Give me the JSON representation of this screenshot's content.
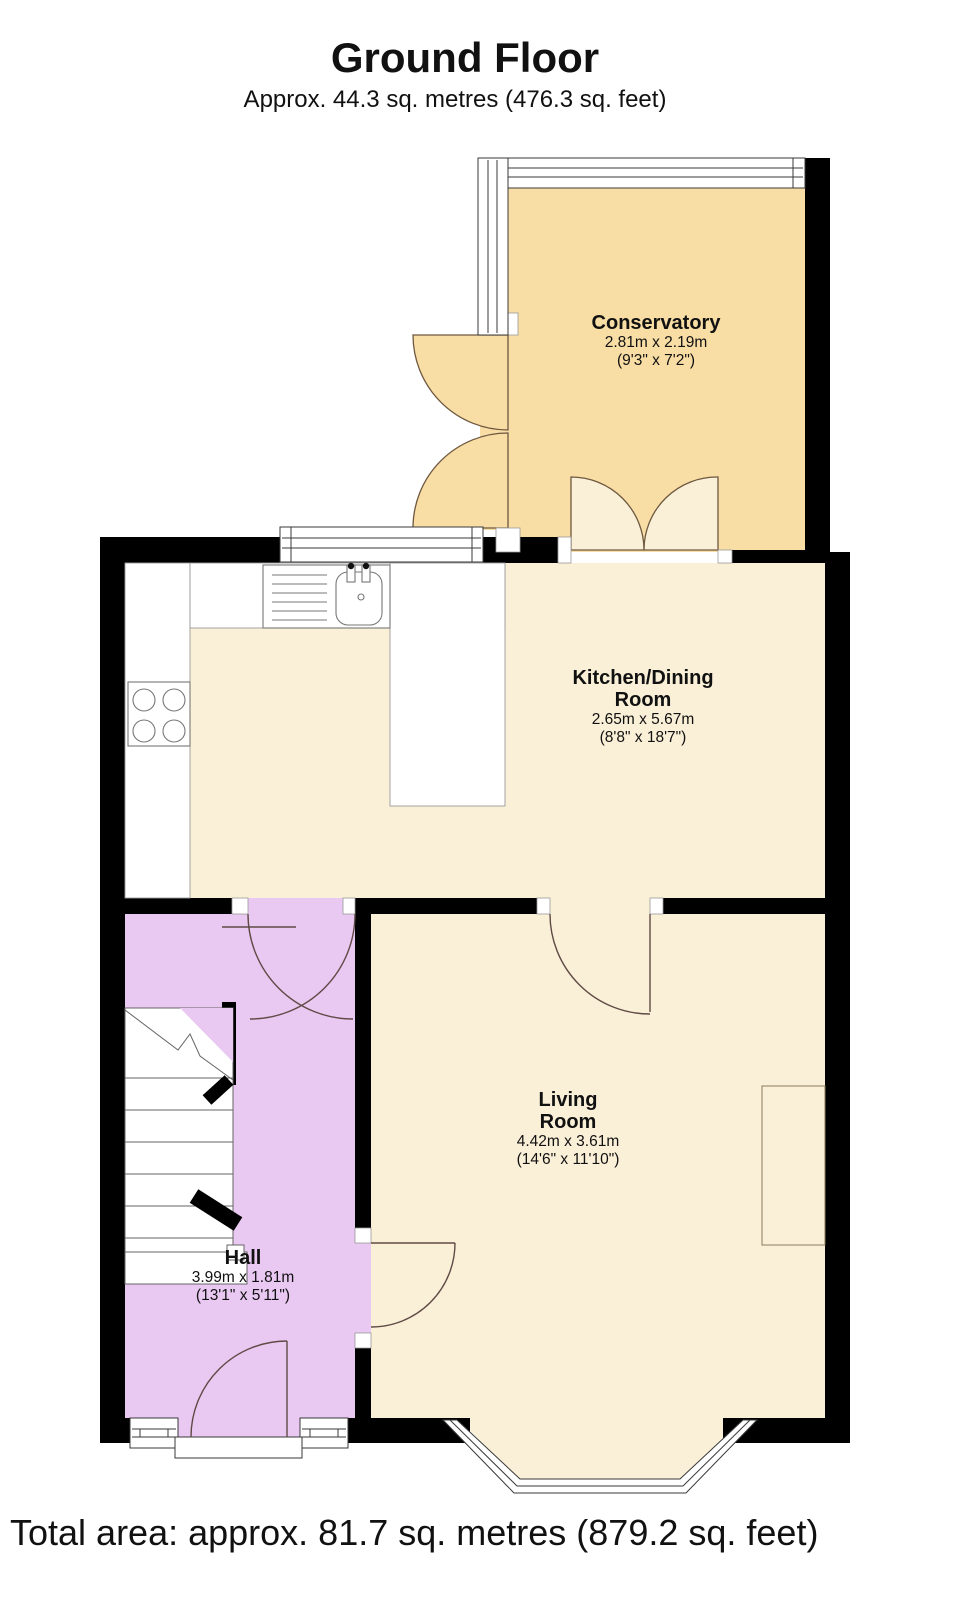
{
  "header": {
    "title": "Ground Floor",
    "subtitle": "Approx. 44.3 sq. metres (476.3 sq. feet)"
  },
  "footer": {
    "total_area": "Total area: approx. 81.7 sq. metres (879.2 sq. feet)"
  },
  "rooms": [
    {
      "id": "conservatory",
      "name": "Conservatory",
      "name_lines": [
        "Conservatory"
      ],
      "size_metric": "2.81m x 2.19m",
      "size_imperial": "(9'3\" x 7'2\")",
      "floor_color": "#f8dda5"
    },
    {
      "id": "kitchen-dining-room",
      "name": "Kitchen/Dining Room",
      "name_lines": [
        "Kitchen/Dining",
        "Room"
      ],
      "size_metric": "2.65m x 5.67m",
      "size_imperial": "(8'8\" x 18'7\")",
      "floor_color": "#faf0d8"
    },
    {
      "id": "living-room",
      "name": "Living Room",
      "name_lines": [
        "Living",
        "Room"
      ],
      "size_metric": "4.42m x 3.61m",
      "size_imperial": "(14'6\" x 11'10\")",
      "floor_color": "#faf0d8"
    },
    {
      "id": "hall",
      "name": "Hall",
      "name_lines": [
        "Hall"
      ],
      "size_metric": "3.99m x 1.81m",
      "size_imperial": "(13'1\" x 5'11\")",
      "floor_color": "#e9c8f2"
    }
  ],
  "colors": {
    "wall": "#000000",
    "conservatory_floor": "#f8dda5",
    "kitchen_living_floor": "#faf0d8",
    "hall_floor": "#e9c8f2",
    "door_arc": "#5f4a45",
    "background": "#ffffff"
  }
}
